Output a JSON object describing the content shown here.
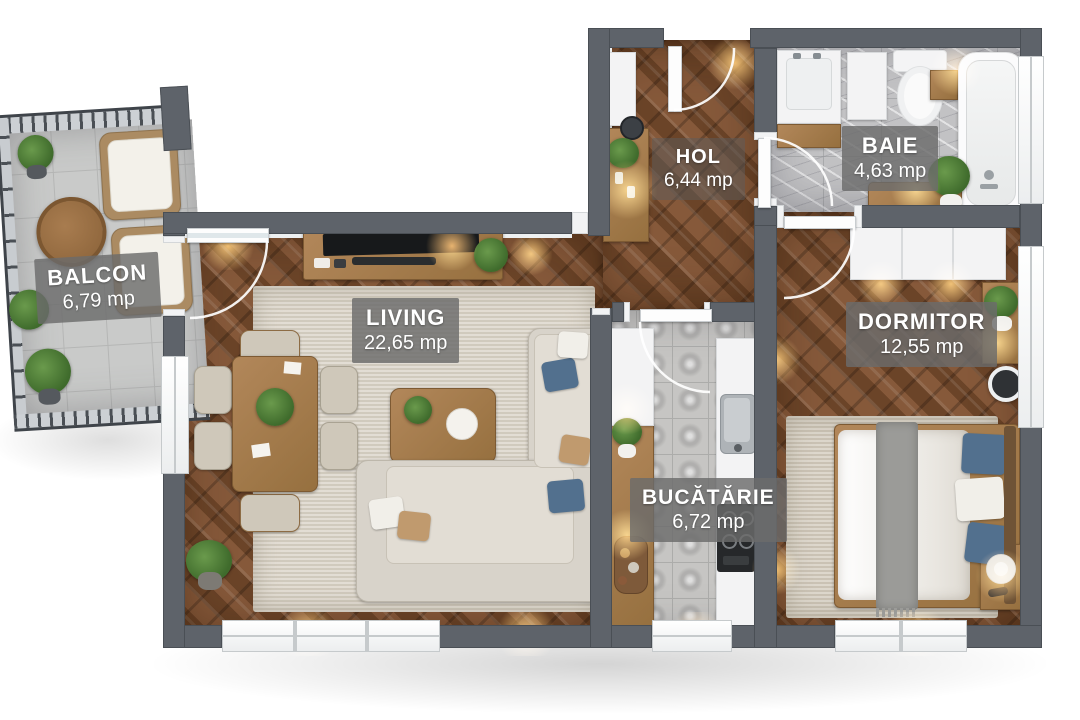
{
  "plan": {
    "unit": "mp",
    "rooms": [
      {
        "name": "BALCON",
        "area": "6,79 mp"
      },
      {
        "name": "LIVING",
        "area": "22,65 mp"
      },
      {
        "name": "HOL",
        "area": "6,44 mp"
      },
      {
        "name": "BAIE",
        "area": "4,63 mp"
      },
      {
        "name": "DORMITOR",
        "area": "12,55 mp"
      },
      {
        "name": "BUCĂTĂRIE",
        "area": "6,72 mp"
      }
    ],
    "colors": {
      "wall": "#5e636a",
      "wood_floor": "#7a5134",
      "tile_floor": "#c9cac9",
      "rug": "#d9d2c5",
      "label_badge": "rgba(107,107,107,0.82)",
      "accent_warm_light": "#ffbe69",
      "pillow_blue": "#52708e",
      "sofa": "#d8d3ca",
      "wood_furniture": "#a87e51"
    }
  }
}
